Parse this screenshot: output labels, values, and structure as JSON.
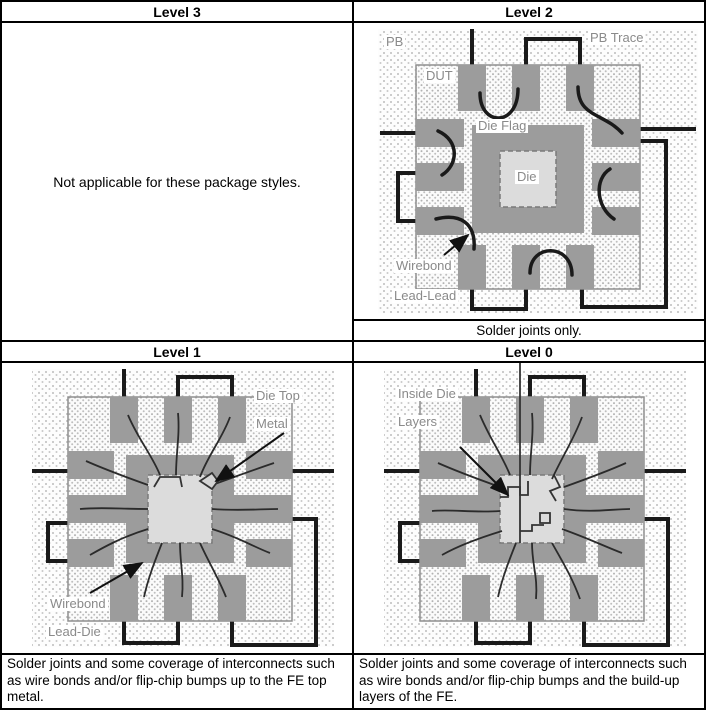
{
  "table": {
    "level3": {
      "header": "Level 3",
      "body": "Not applicable for these package styles."
    },
    "level2": {
      "header": "Level 2",
      "caption": "Solder joints only.",
      "labels": {
        "pb": "PB",
        "pb_trace": "PB Trace",
        "dut": "DUT",
        "die_flag": "Die Flag",
        "die": "Die",
        "wirebond": "Wirebond",
        "lead_lead": "Lead-Lead"
      }
    },
    "level1": {
      "header": "Level 1",
      "caption": "Solder joints and some coverage of interconnects such as wire bonds and/or flip-chip bumps up to the FE top metal.",
      "labels": {
        "die_top_1": "Die Top",
        "die_top_2": "Metal",
        "wirebond": "Wirebond",
        "lead_die": "Lead-Die"
      }
    },
    "level0": {
      "header": "Level 0",
      "caption": "Solder joints and some coverage of interconnects such as wire bonds and/or flip-chip bumps and the build-up layers of the FE.",
      "labels": {
        "inside_die_1": "Inside Die",
        "inside_die_2": "Layers"
      }
    },
    "colors": {
      "lead_gray": "#9c9c9c",
      "die_gray": "#dcdcdc",
      "trace_black": "#1a1a1a",
      "label_gray": "#8a8a8a",
      "border_black": "#000000"
    }
  }
}
